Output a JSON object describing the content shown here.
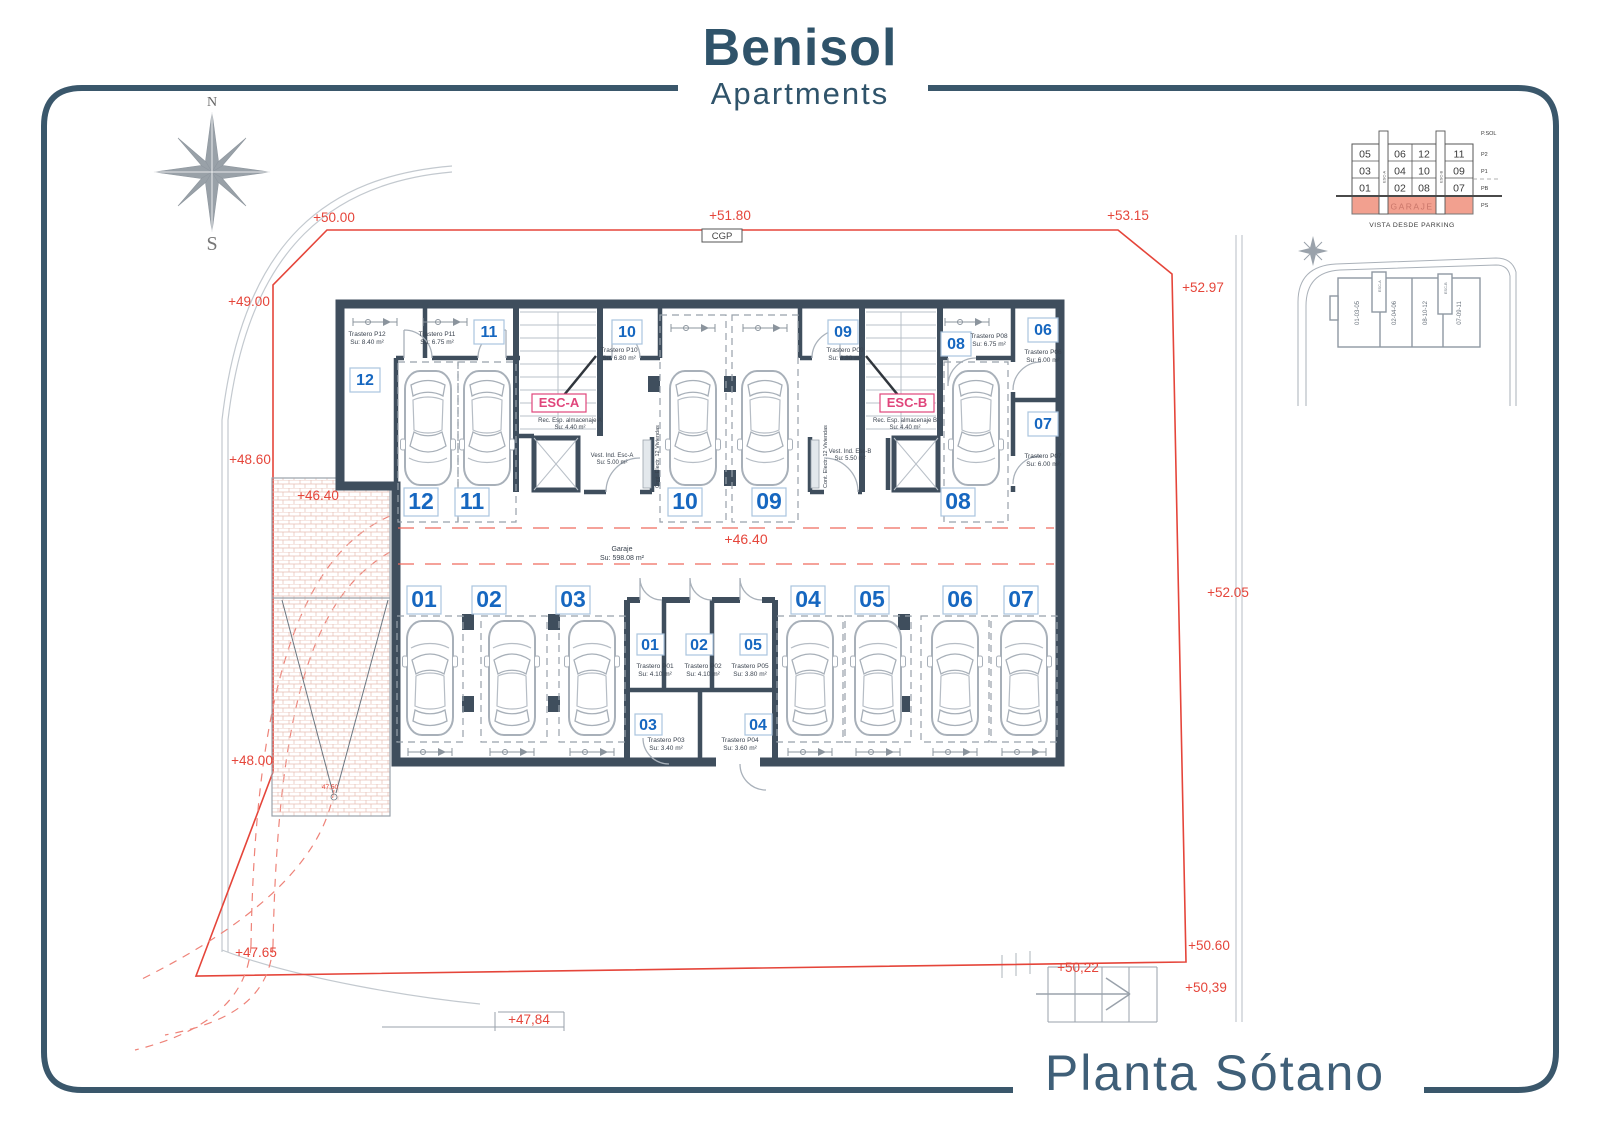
{
  "header": {
    "title": "Benisol",
    "subtitle": "Apartments"
  },
  "footer": {
    "title": "Planta Sótano"
  },
  "compass": {
    "north": "N",
    "south": "S"
  },
  "boundary": {
    "cgp": "CGP",
    "elev_top_left": "+50.00",
    "elev_top_center": "+51.80",
    "elev_top_right": "+53.15",
    "elev_left_1": "+49.00",
    "elev_left_2": "+48.60",
    "elev_ramp": "+46.40",
    "elev_left_3": "+48.00",
    "elev_left_4": "+47.65",
    "elev_right_1": "+52.97",
    "elev_right_2": "+52.05",
    "elev_right_3": "+50.60",
    "elev_right_4": "+50,39",
    "elev_bottom_1": "+50,22",
    "elev_bottom_2": "+47,84",
    "elev_ramp_low": "47,50"
  },
  "garage": {
    "level": "+46.40",
    "name": "Garaje",
    "area": "Su: 598.08 m²",
    "spaces_top": [
      "12",
      "11",
      "10",
      "09",
      "08"
    ],
    "spaces_bottom": [
      "01",
      "02",
      "03",
      "04",
      "05",
      "06",
      "07"
    ]
  },
  "storage": {
    "p01": {
      "id": "01",
      "name": "Trastero P01",
      "area": "Su: 4.10 m²"
    },
    "p02": {
      "id": "02",
      "name": "Trastero P02",
      "area": "Su: 4.10 m²"
    },
    "p03": {
      "id": "03",
      "name": "Trastero P03",
      "area": "Su: 3.40 m²"
    },
    "p04": {
      "id": "04",
      "name": "Trastero P04",
      "area": "Su: 3.60 m²"
    },
    "p05": {
      "id": "05",
      "name": "Trastero P05",
      "area": "Su: 3.80 m²"
    },
    "p06": {
      "id": "06",
      "name": "Trastero P06",
      "area": "Su: 6.00 m²"
    },
    "p07": {
      "id": "07",
      "name": "Trastero P07",
      "area": "Su: 6.00 m²"
    },
    "p08": {
      "id": "08",
      "name": "Trastero P08",
      "area": "Su: 6.75 m²"
    },
    "p09": {
      "id": "09",
      "name": "Trastero P09",
      "area": "Su: 6.80 m²"
    },
    "p10": {
      "id": "10",
      "name": "Trastero P10",
      "area": "Su: 6.80 m²"
    },
    "p11": {
      "id": "11",
      "name": "Trastero P11",
      "area": "Su: 6.75 m²"
    },
    "p12": {
      "id": "12",
      "name": "Trastero P12",
      "area": "Su: 8.40 m²"
    }
  },
  "stairs": {
    "esc_a": {
      "label": "ESC-A",
      "storage_name": "Rec. Esp. almacenaje A",
      "storage_area": "Su: 4.40 m²",
      "vest_name": "Vest. Ind. Esc-A",
      "vest_area": "Su: 5.00 m²",
      "cabinet": "Cont. Electr. 12 Viviendas"
    },
    "esc_b": {
      "label": "ESC-B",
      "storage_name": "Rec. Esp. almacenaje B",
      "storage_area": "Su: 4.40 m²",
      "vest_name": "Vest. Ind. Esc-B",
      "vest_area": "Su: 5.50 m²",
      "cabinet": "Cont. Electr. 12 Viviendas"
    }
  },
  "parking_view": {
    "caption": "VISTA DESDE PARKING",
    "floor_labels": [
      "P.SOL",
      "P2",
      "P1",
      "PB",
      "PS"
    ],
    "rows": [
      [
        "05",
        "06",
        "12",
        "11"
      ],
      [
        "03",
        "04",
        "10",
        "09"
      ],
      [
        "01",
        "02",
        "08",
        "07"
      ]
    ],
    "garage_label": "GARAJE",
    "esc_a": "ESC-A",
    "esc_b": "ESC-B"
  },
  "site_key": {
    "sections": [
      "01-03-05",
      "02-04-06",
      "08-10-12",
      "07-09-11"
    ],
    "esc_a": "ESC-A",
    "esc_b": "ESC-B"
  },
  "colors": {
    "accent_red": "#E5453A",
    "accent_blue": "#1667C0",
    "accent_magenta": "#E0457B",
    "frame": "#3A576B",
    "wall": "#3F4E5D",
    "garage_band": "#F2A08F"
  }
}
